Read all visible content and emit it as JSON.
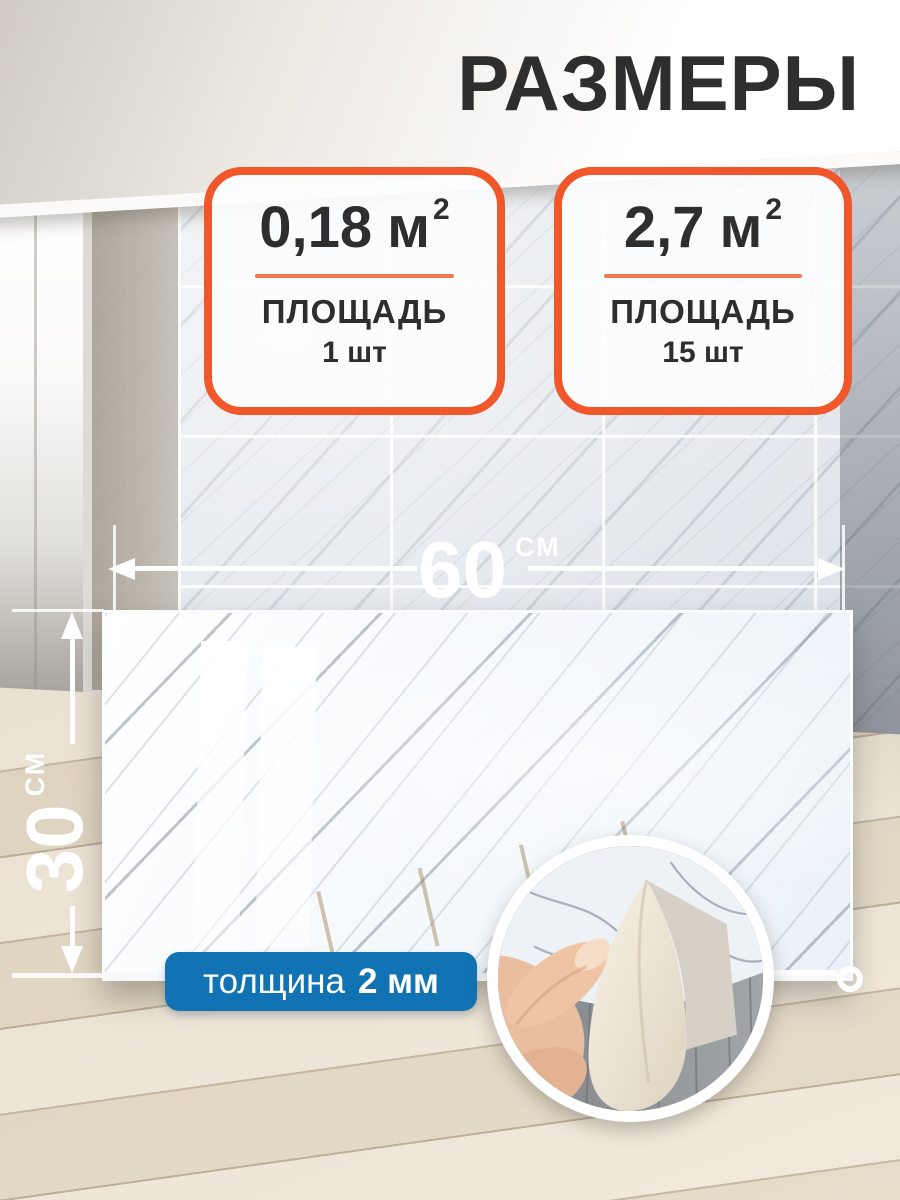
{
  "title": "РАЗМЕРЫ",
  "cards": [
    {
      "value": "0,18",
      "unit": "м",
      "exponent": "2",
      "label": "ПЛОЩАДЬ",
      "count": "1 шт"
    },
    {
      "value": "2,7",
      "unit": "м",
      "exponent": "2",
      "label": "ПЛОЩАДЬ",
      "count": "15 шт"
    }
  ],
  "dimensions": {
    "width": {
      "value": "60",
      "unit": "СМ"
    },
    "height": {
      "value": "30",
      "unit": "СМ"
    }
  },
  "thickness": {
    "label": "толщина",
    "value": "2 мм"
  },
  "icons": {
    "width_arrow": "double-headed-arrow",
    "height_arrow": "double-headed-arrow",
    "detail_inset": "magnified-circle-callout",
    "corner_marker": "ring"
  },
  "colors": {
    "accent_orange": "#F0582B",
    "divider_orange": "#F0794F",
    "accent_blue": "#1173B4",
    "text_dark": "#2E2E2E",
    "white": "#FFFFFF"
  }
}
